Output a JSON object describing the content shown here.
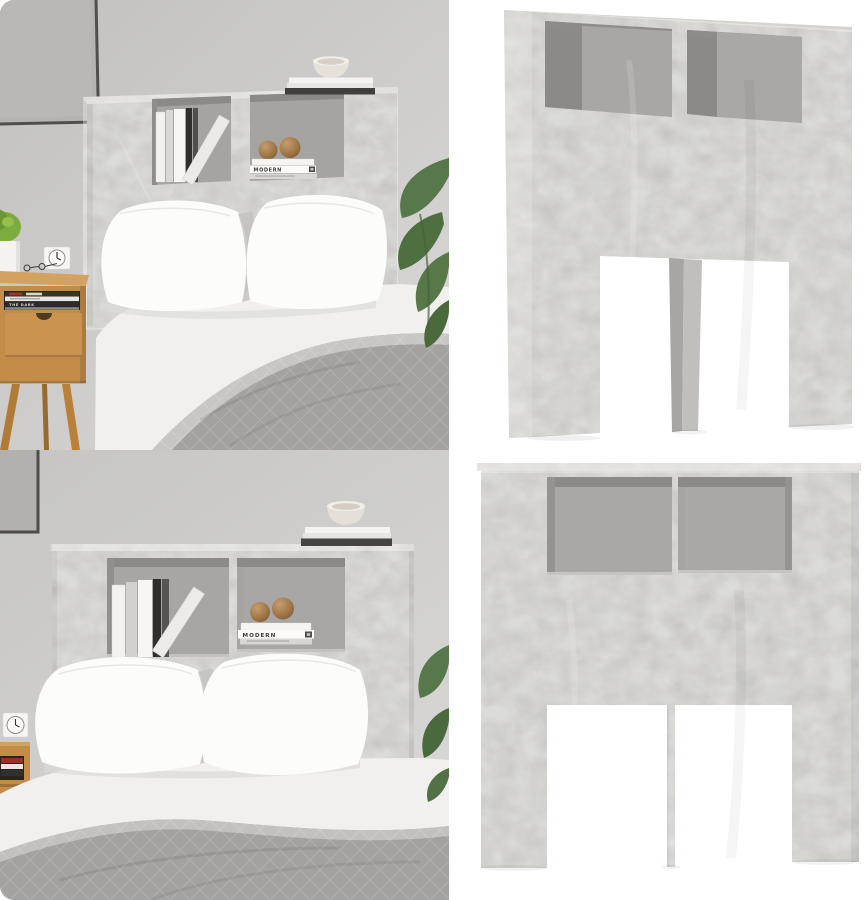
{
  "gallery": {
    "name": "headboard-cabinet-photo-collage",
    "grid": "2x2",
    "panels": [
      {
        "id": "bedroom-angled-view",
        "setting": "styled bedroom",
        "view": "angled"
      },
      {
        "id": "studio-angled-view",
        "setting": "white studio",
        "view": "angled"
      },
      {
        "id": "bedroom-front-view",
        "setting": "styled bedroom",
        "view": "front"
      },
      {
        "id": "studio-front-view",
        "setting": "white studio",
        "view": "front"
      }
    ]
  },
  "text": {
    "modern_book_spine": "MODERN",
    "nightstand_book_spine": "THE DARK"
  },
  "colors": {
    "concrete_grey": "#bbbab7",
    "concrete_top": "#d4d3d0",
    "compartment_back": "#a5a4a1",
    "compartment_shadow": "#8b8a87",
    "wall_grey": "#cccbc9",
    "studio_white": "#ffffff",
    "bedding_white": "#f1f0ee",
    "pillow_white": "#fcfcfb",
    "blanket_grey": "#a3a2a0",
    "oak_wood": "#c48c49",
    "plant_green": "#57784a",
    "wood_ball_brown": "#9a7244",
    "book_dark": "#2f2e2d",
    "book_white": "#f4f3f1"
  }
}
